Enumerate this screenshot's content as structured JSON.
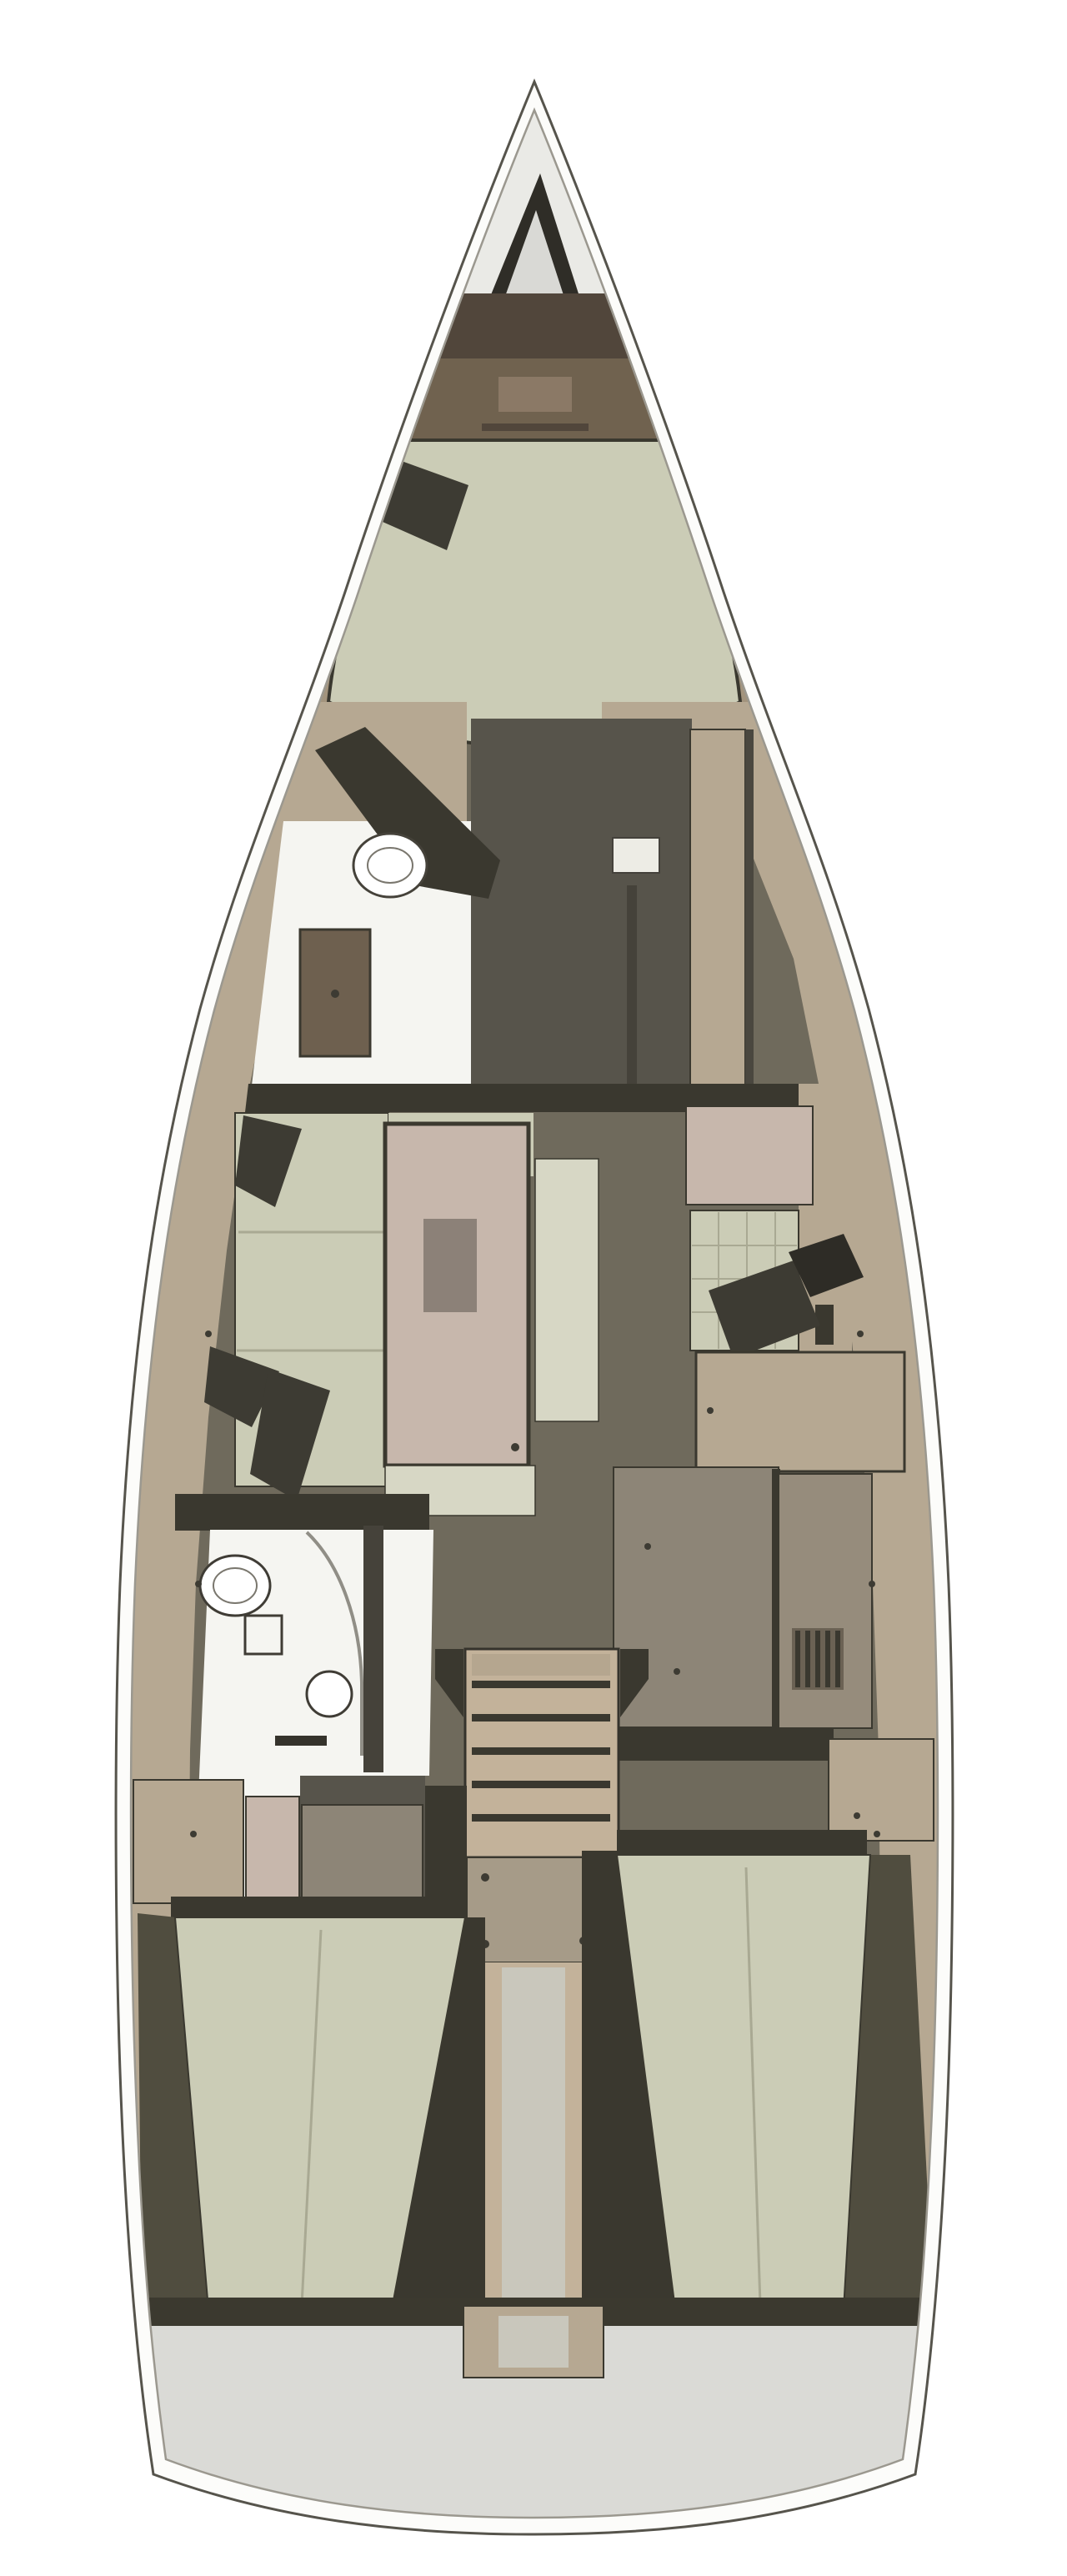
{
  "meta": {
    "title": "Sailing yacht interior layout floor plan",
    "view": "top-down",
    "orientation": "bow-up"
  },
  "regions": [
    {
      "name": "bow-anchor-locker"
    },
    {
      "name": "forward-cabin-headboard"
    },
    {
      "name": "forward-cabin-v-berth"
    },
    {
      "name": "forward-head"
    },
    {
      "name": "forward-walkway"
    },
    {
      "name": "wardrobe"
    },
    {
      "name": "saloon-port-settee"
    },
    {
      "name": "saloon-table"
    },
    {
      "name": "saloon-chaise"
    },
    {
      "name": "navigation-seat"
    },
    {
      "name": "navigation-desk"
    },
    {
      "name": "galley"
    },
    {
      "name": "companionway-steps"
    },
    {
      "name": "engine-compartment"
    },
    {
      "name": "aft-head"
    },
    {
      "name": "port-aft-cabin-berth"
    },
    {
      "name": "starboard-aft-cabin-berth"
    },
    {
      "name": "transom-swim-platform"
    }
  ],
  "colors": {
    "hull_white": "#fcfcfa",
    "hull_stroke": "#56544c",
    "inner_line": "#9b988f",
    "bow_deck": "#eaeae6",
    "locker_dark": "#2f2d27",
    "locker_inner": "#d9d9d5",
    "headboard_dark": "#51463b",
    "headboard_brown": "#70624f",
    "headboard_light": "#8b7966",
    "berth_green": "#cbccb6",
    "berth_green_light": "#d7d7c5",
    "cushion_shadow": "#a9a993",
    "deck_tan": "#b6a892",
    "deck_tan_dark": "#a3947d",
    "floor_olive": "#6f6a5c",
    "floor_dark": "#57544b",
    "worktop_gray": "#8d8577",
    "unit_gray": "#968c7c",
    "seam_dark": "#3a382f",
    "white_floor": "#f5f5f1",
    "fixture_white": "#ffffff",
    "wood_brown": "#6e604f",
    "table_pink": "#c7b7ac",
    "table_inset": "#8c8178",
    "pillow_dark": "#3d3b33",
    "steps_tan": "#c3b29a",
    "steps_cap": "#b5a68f",
    "engine_gray": "#a69b88",
    "transom_gray": "#dadad6",
    "transom_edge": "#3b392f",
    "glass_line": "#908e86",
    "label_white": "#edece5",
    "walk_gray": "#c9c7bc",
    "rail_dark": "#4a4638"
  }
}
